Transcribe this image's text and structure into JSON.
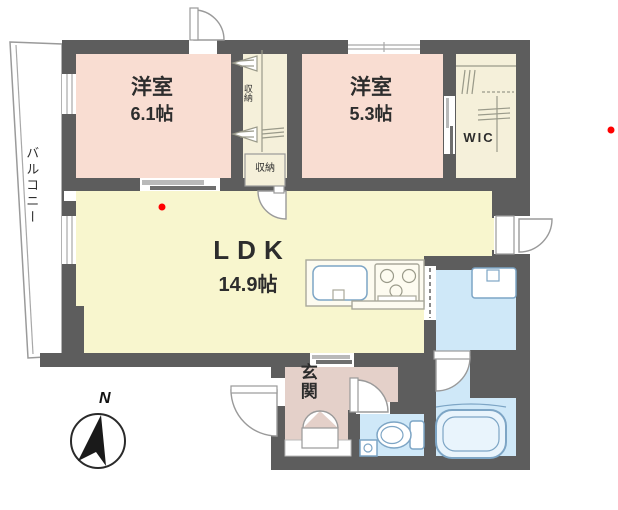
{
  "floorplan": {
    "balcony_label": "バルコニー",
    "bedroom1": {
      "name": "洋室",
      "size": "6.1帖"
    },
    "bedroom2": {
      "name": "洋室",
      "size": "5.3帖"
    },
    "ldk": {
      "name": "LDK",
      "size": "14.9帖"
    },
    "wic_label": "WIC",
    "genkan_label": "玄関",
    "closet_tall_label": "収納",
    "closet_small_label": "収納",
    "compass_label": "N",
    "colors": {
      "wall": "#5d5d5d",
      "bedroom": "#f9ddd2",
      "ldk": "#f8f6ce",
      "closet": "#f5f0da",
      "genkan": "#e4d0c9",
      "wet": "#cfe8f8",
      "marker": "#ff0000"
    }
  }
}
